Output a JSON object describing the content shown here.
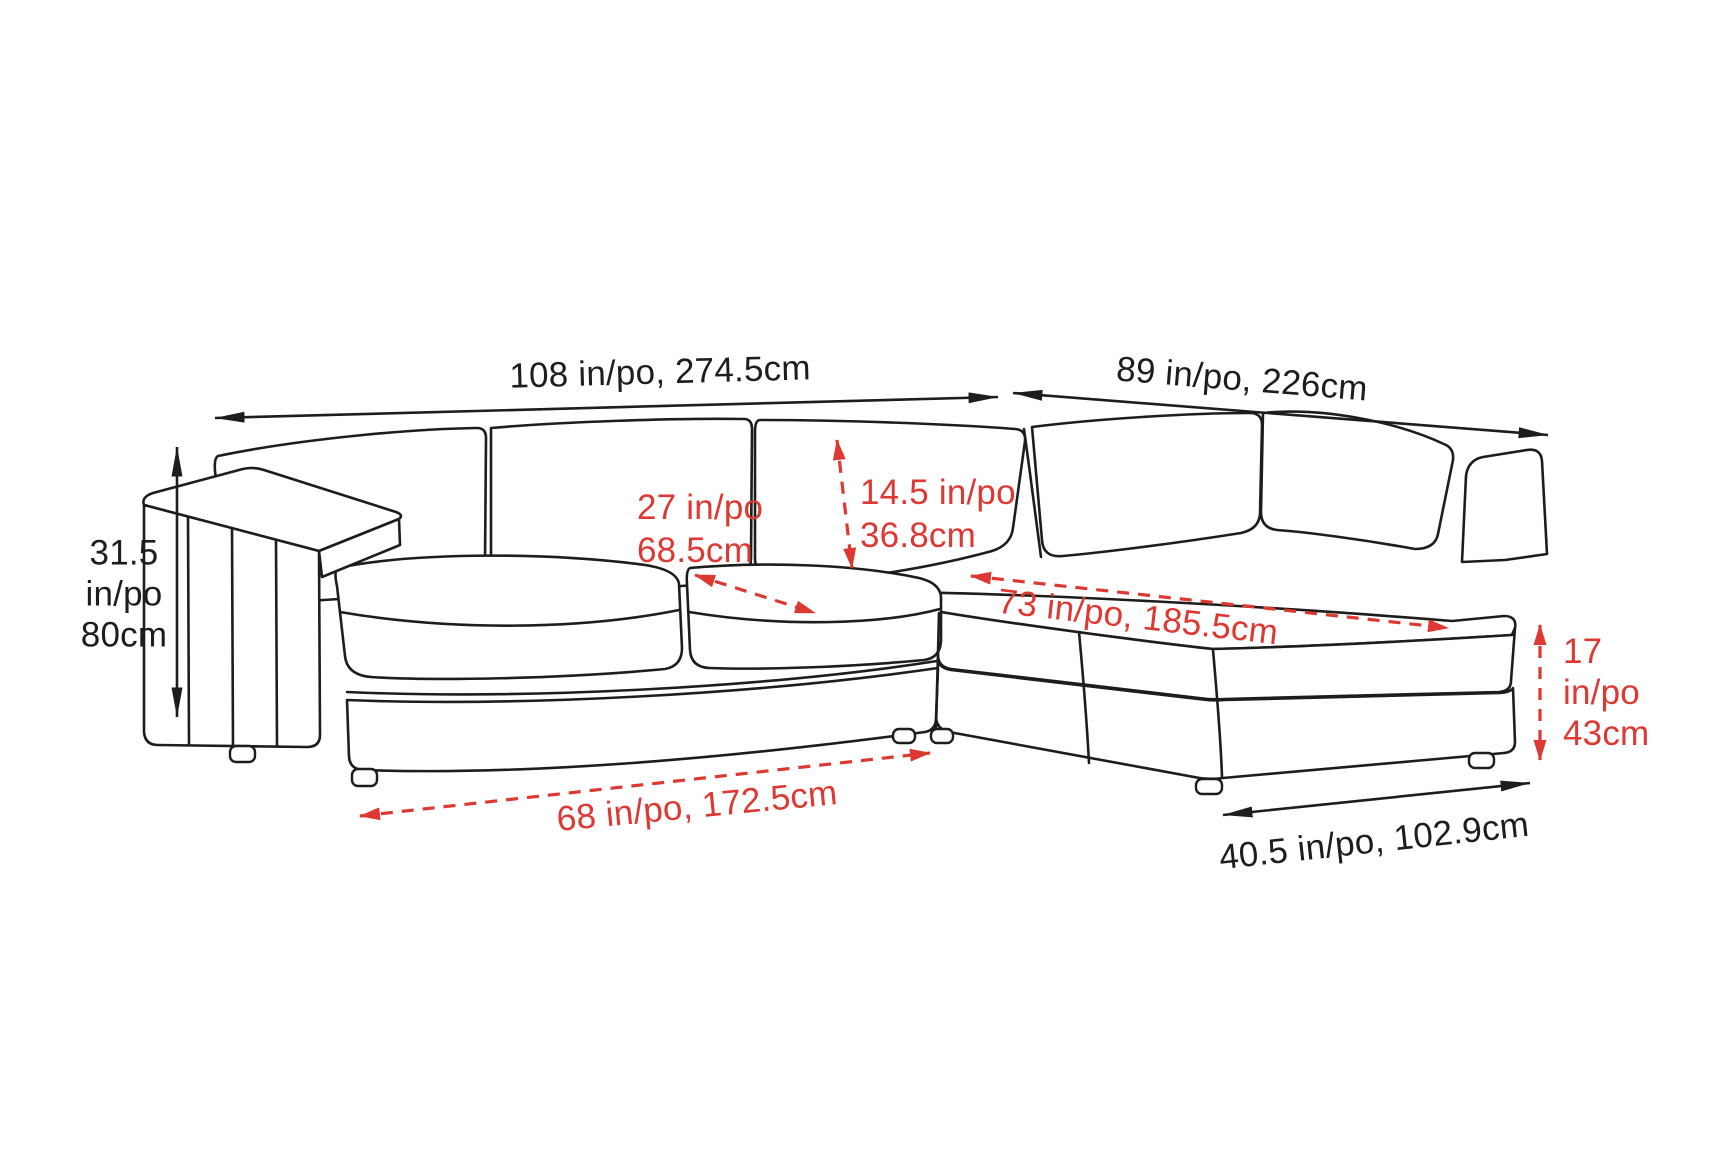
{
  "meta": {
    "type": "furniture-dimension-diagram",
    "subject": "sectional-sofa-with-chaise"
  },
  "colors": {
    "line": "#1d1d1b",
    "annotation_red": "#dd3831",
    "text_black": "#1d1d1b",
    "background": "#ffffff"
  },
  "labels": {
    "left_width": "108 in/po, 274.5cm",
    "right_width": "89 in/po, 226cm",
    "overall_height": {
      "l1": "31.5",
      "l2": "in/po",
      "l3": "80cm"
    },
    "seat_depth": {
      "l1": "27 in/po",
      "l2": "68.5cm"
    },
    "back_cushion_height": {
      "l1": "14.5 in/po",
      "l2": "36.8cm"
    },
    "chaise_length": "73 in/po, 185.5cm",
    "seat_width": "68 in/po, 172.5cm",
    "chaise_width": "40.5 in/po, 102.9cm",
    "seat_height": {
      "l1": "17",
      "l2": "in/po",
      "l3": "43cm"
    }
  }
}
